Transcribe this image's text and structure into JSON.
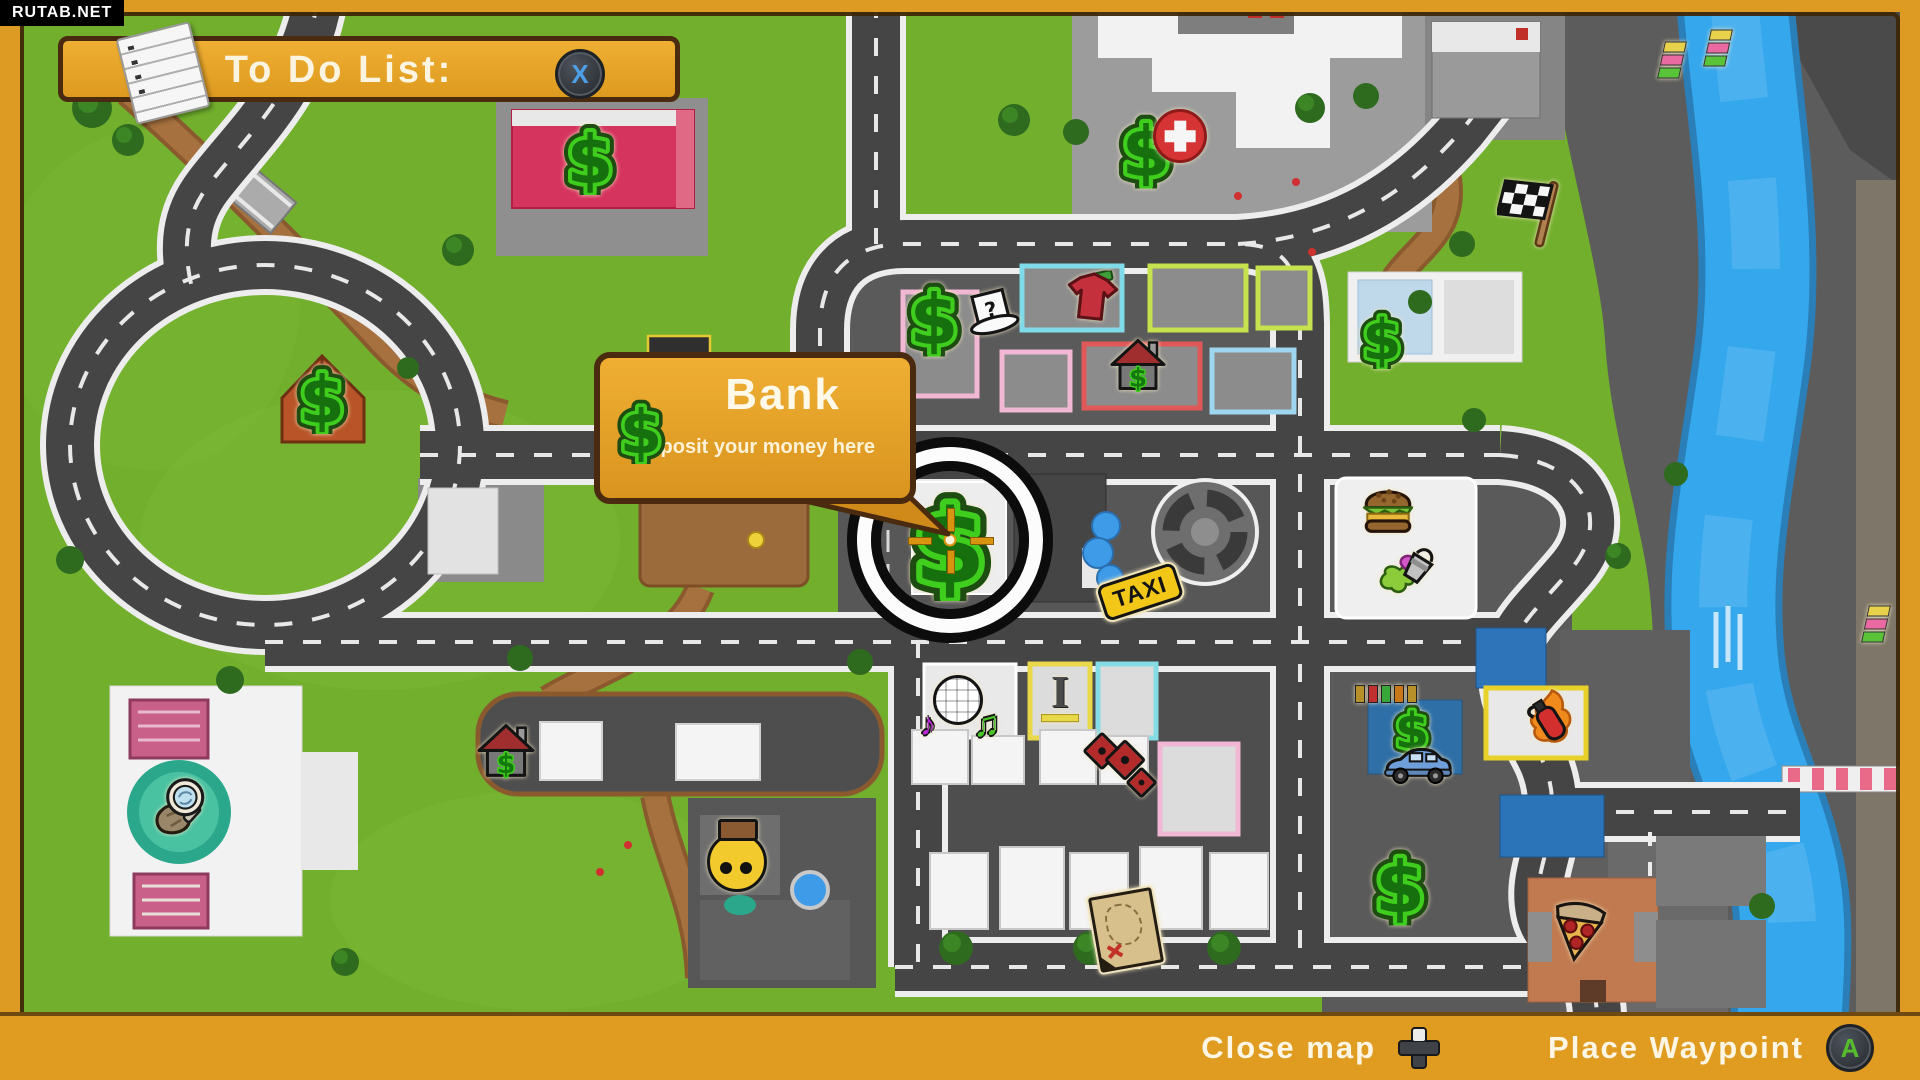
{
  "watermark": "RUTAB.NET",
  "todo_banner": {
    "title": "To Do List:",
    "close_button": "X"
  },
  "tooltip": {
    "title": "Bank",
    "subtitle": "Deposit your money here"
  },
  "bottom_bar": {
    "close_label": "Close map",
    "close_icon": "dpad-icon",
    "waypoint_label": "Place Waypoint",
    "waypoint_button": "A"
  },
  "colors": {
    "banner_orange": "#E8A42C",
    "frame_orange": "#DE9B24",
    "border_brown": "#4A2B10",
    "money_green": "#3FCE1D",
    "grass_green": "#72AF2D",
    "road_gray": "#454545",
    "river_blue": "#35A7EC",
    "taxi_yellow": "#F2C718",
    "x_button_blue": "#4D9FE8",
    "a_button_green": "#56BE2C"
  },
  "markers": [
    {
      "id": "money-garage-topleft",
      "type": "money",
      "x": 590,
      "y": 160,
      "s": 60,
      "glyph": "$"
    },
    {
      "id": "money-left-hill",
      "type": "money",
      "x": 322,
      "y": 400,
      "s": 58,
      "glyph": "$"
    },
    {
      "id": "money-hospital",
      "type": "money",
      "x": 1146,
      "y": 152,
      "s": 62,
      "glyph": "$"
    },
    {
      "id": "hospital-cross-icon",
      "type": "medical",
      "x": 1180,
      "y": 136,
      "s": 48
    },
    {
      "id": "race-flag-icon",
      "type": "flag",
      "x": 1532,
      "y": 212
    },
    {
      "id": "money-clothes-shop",
      "type": "money",
      "x": 934,
      "y": 320,
      "s": 62,
      "glyph": "$"
    },
    {
      "id": "mystery-hat-icon",
      "type": "tophat",
      "x": 992,
      "y": 316,
      "glyph": "?"
    },
    {
      "id": "tshirt-shop-icon",
      "type": "shirt",
      "x": 1092,
      "y": 300
    },
    {
      "id": "estate-house-icon",
      "type": "house",
      "x": 1138,
      "y": 368,
      "s": 58,
      "glyph": "$"
    },
    {
      "id": "money-topright",
      "type": "money",
      "x": 1382,
      "y": 340,
      "s": 50,
      "glyph": "$"
    },
    {
      "id": "bank-money-icon",
      "type": "money",
      "x": 950,
      "y": 546,
      "s": 92,
      "glyph": "$"
    },
    {
      "id": "burger-icon",
      "type": "burger",
      "x": 1388,
      "y": 510
    },
    {
      "id": "paint-bucket-icon",
      "type": "paint",
      "x": 1406,
      "y": 568
    },
    {
      "id": "taxi-rank-sign",
      "type": "taxi",
      "x": 1140,
      "y": 592,
      "label": "TAXI"
    },
    {
      "id": "disco-ball-icon",
      "type": "disco",
      "x": 958,
      "y": 700,
      "glyph": "♪",
      "glyph2": "♫"
    },
    {
      "id": "furniture-shop-icon",
      "type": "bench",
      "x": 1060,
      "y": 698,
      "glyph": "I"
    },
    {
      "id": "dice-shop-icon",
      "type": "dice",
      "x": 1120,
      "y": 766
    },
    {
      "id": "house-left-icon",
      "type": "house",
      "x": 506,
      "y": 754,
      "s": 60,
      "glyph": "$"
    },
    {
      "id": "smiley-balloon-icon",
      "type": "smiley",
      "x": 737,
      "y": 862
    },
    {
      "id": "treasure-map-icon",
      "type": "treasuremap",
      "x": 1126,
      "y": 930
    },
    {
      "id": "money-bottomright",
      "type": "money",
      "x": 1400,
      "y": 888,
      "s": 64,
      "glyph": "$"
    },
    {
      "id": "pizza-icon",
      "type": "pizza",
      "x": 1578,
      "y": 934
    },
    {
      "id": "money-carwash",
      "type": "money",
      "x": 1412,
      "y": 732,
      "s": 44,
      "glyph": "$"
    },
    {
      "id": "car-dealer-icon",
      "type": "car",
      "x": 1418,
      "y": 768
    },
    {
      "id": "fire-extinguisher-icon",
      "type": "extinguisher",
      "x": 1550,
      "y": 722
    },
    {
      "id": "traffic-lights-icon",
      "type": "trafficlight",
      "x": 1386,
      "y": 694
    },
    {
      "id": "museum-magnifier-icon",
      "type": "magnifier",
      "x": 179,
      "y": 810
    },
    {
      "id": "flags-ramp-1",
      "type": "flagstack",
      "x": 1672,
      "y": 60
    },
    {
      "id": "flags-ramp-2",
      "type": "flagstack",
      "x": 1718,
      "y": 48
    },
    {
      "id": "flags-riverside",
      "type": "flagstack",
      "x": 1876,
      "y": 624
    }
  ]
}
